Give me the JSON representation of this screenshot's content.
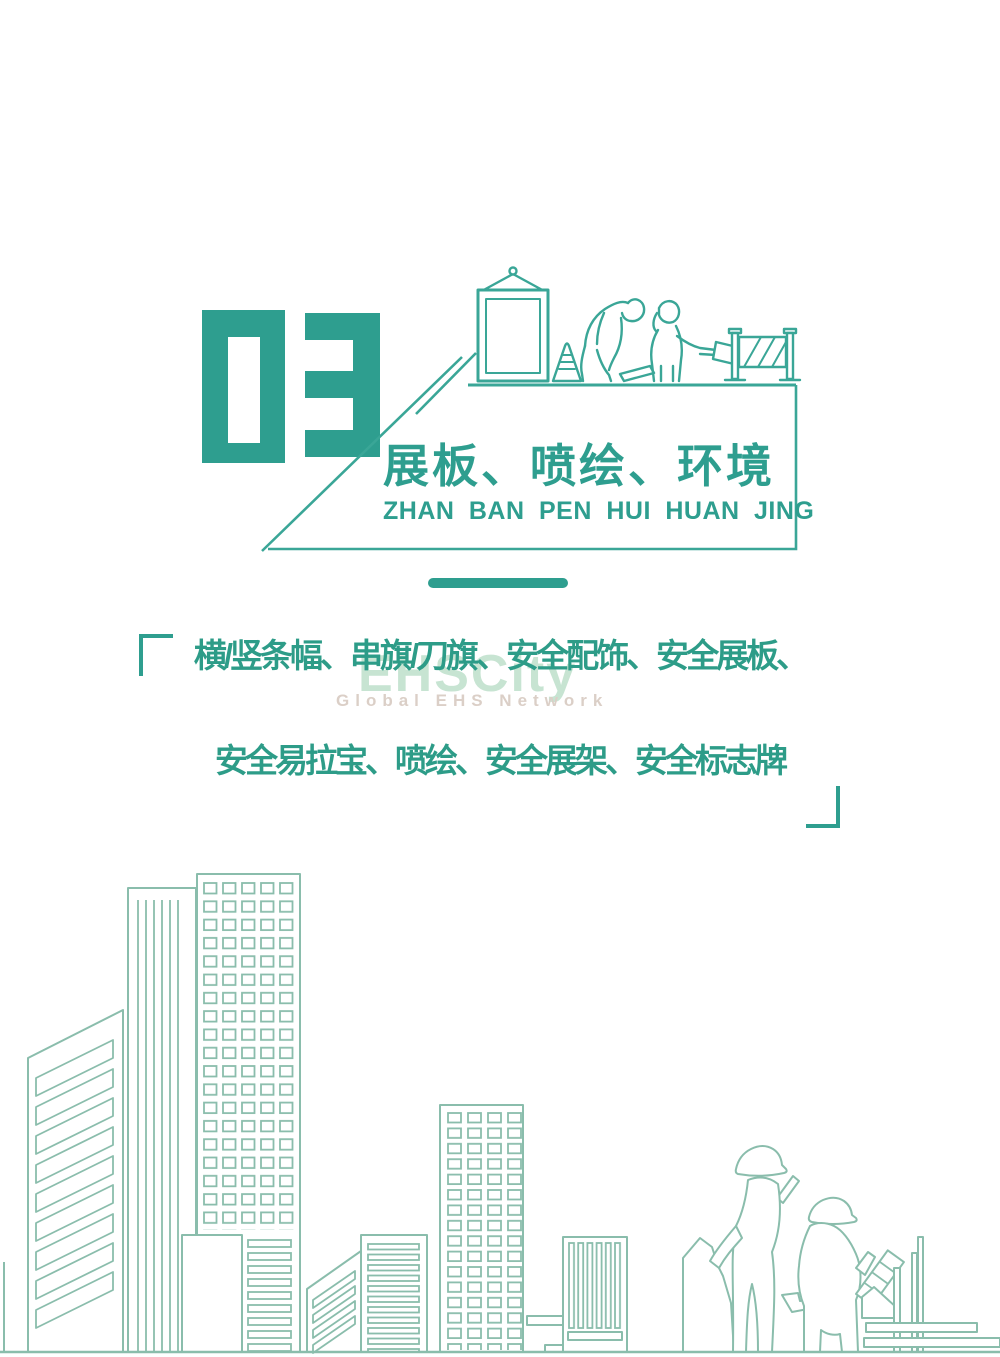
{
  "page": {
    "width": 1000,
    "height": 1357,
    "background": "#ffffff"
  },
  "colors": {
    "accent_teal": "#2e9e8f",
    "illustration_line": "#3aa697",
    "skyline_line": "#8abdac",
    "watermark_green": "#c7e4d2",
    "watermark_gray": "#dbcfc7"
  },
  "header": {
    "section_number": "03",
    "title": "展板、喷绘、环境",
    "subtitle_pinyin": "ZHAN BAN PEN HUI HUAN JING"
  },
  "description": {
    "line1": "横/竖条幅、串旗/刀旗、安全配饰、安全展板、",
    "line2": "安全易拉宝、喷绘、安全展架、安全标志牌"
  },
  "watermark": {
    "brand": "EHSCity",
    "tagline": "Global EHS Network"
  }
}
